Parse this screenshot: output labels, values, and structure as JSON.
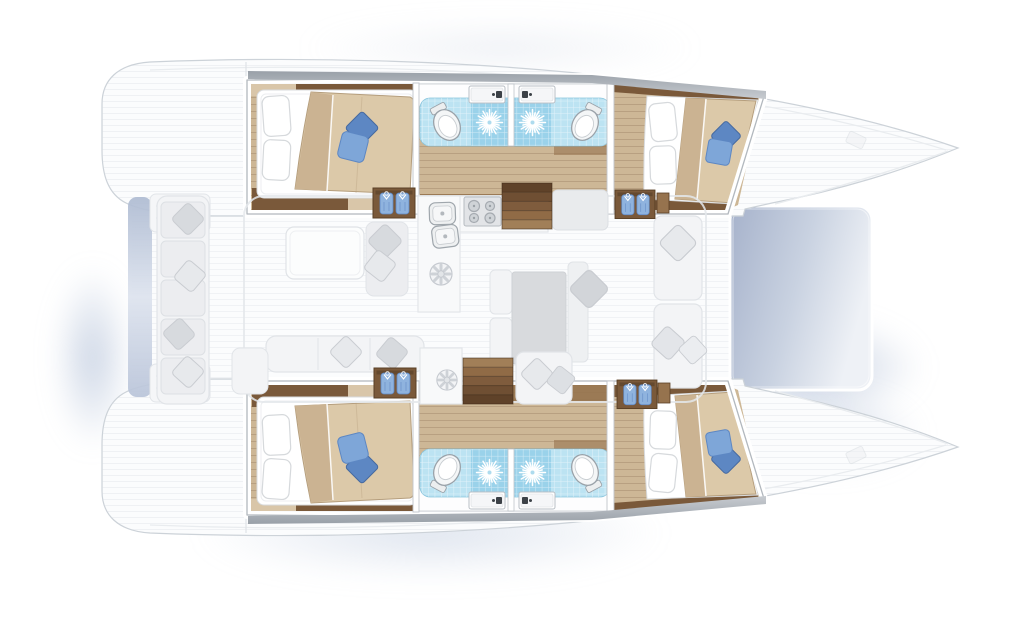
{
  "document": {
    "kind": "yacht-interior-floor-plan",
    "vessel": "catamaran",
    "view": "top-down",
    "bow_direction": "right",
    "visible_text": []
  },
  "layout": {
    "port_hull": [
      "aft-double-cabin",
      "aft-bathroom",
      "forward-bathroom",
      "forward-double-cabin",
      "wardrobe-aft",
      "wardrobe-forward",
      "companionway-stairs"
    ],
    "starboard_hull": [
      "aft-double-cabin",
      "aft-bathroom",
      "forward-bathroom",
      "forward-double-cabin",
      "wardrobe-aft",
      "wardrobe-forward",
      "companionway-stairs"
    ],
    "bridge_deck": [
      "aft-cockpit-bench",
      "cockpit-table",
      "side-seat",
      "aft-sofa",
      "galley-counter",
      "galley-double-sink",
      "galley-stove",
      "galley-vents",
      "dining-table",
      "dining-benches",
      "forward-lounge-seats",
      "foredeck",
      "trampoline"
    ]
  },
  "counts": {
    "double_cabins": 4,
    "bathrooms": 4,
    "toilets": 4,
    "showers": 4,
    "vanity_sinks": 4,
    "galley_sinks": 2,
    "stove_burners": 4,
    "wardrobes": 4,
    "staircases": 2,
    "blue_bed_cushions": 6
  },
  "icons": [
    "toilet-icon",
    "shower-sun-icon",
    "vanity-sink-icon",
    "galley-sink-icon",
    "stove-burners-icon",
    "vent-fan-icon",
    "wardrobe-garments-icon",
    "bed-pillows-icon",
    "stairs-icon",
    "trampoline-panel",
    "transom-platform"
  ],
  "colors": {
    "bg": "#ffffff",
    "hull": "#fbfcfd",
    "hullStroke": "#ccd2d8",
    "gunwale": "#e9ecef",
    "wall": "#ffffff",
    "wallStroke": "#b2b8be",
    "band1": "#99a0a8",
    "band2": "#c7cbd0",
    "woodDark": "#7a593a",
    "woodMid": "#96734e",
    "floorTan": "#cdb796",
    "floorTanLight": "#d9c6a9",
    "duvet": "#dcc9a9",
    "duvetFold": "#cbb392",
    "duvetEdge": "#b59e7d",
    "pillowStroke": "#d6d9dc",
    "blueDark": "#5d87c3",
    "blueMid": "#7ea6d8",
    "garment": "#8fb3de",
    "garmentFold": "#6089c4",
    "tile": "#bce3f2",
    "tileShower": "#9ad2ea",
    "tileStroke": "#86c3dc",
    "fixtureStroke": "#9aa2a9",
    "fadedFill": "#f3f4f6",
    "fadedFill2": "#ecedf0",
    "fadedStroke": "#e1e4e8",
    "cushion": "#d7dade",
    "cushionLight": "#e7e9ec",
    "cushionStroke": "#c9ccd1",
    "tableGrey": "#d8dadd",
    "trampA": "#a6b2cb",
    "trampB": "#eef1f6",
    "transom": "#aebbd2",
    "stair1": "#5f4229",
    "stair2": "#6f4f33",
    "stair3": "#7f5c3d",
    "stair4": "#906b46",
    "stair5": "#a17f58"
  }
}
